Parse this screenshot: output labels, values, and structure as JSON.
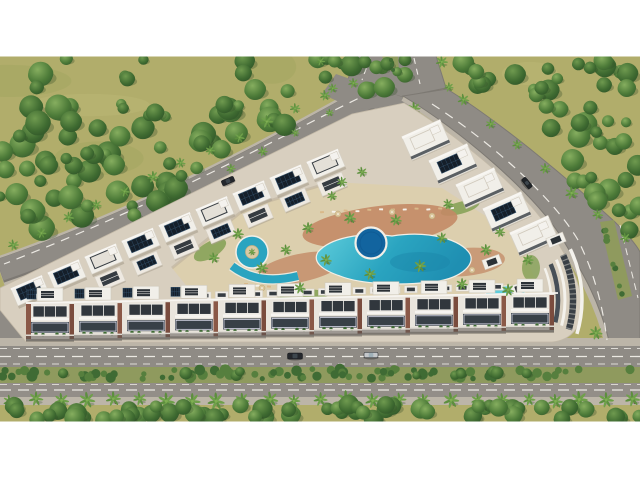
{
  "scene": {
    "title": "Aerial 3D architectural render of a residential resort complex",
    "style": "top-down oblique 3D visualization, letterboxed with white bars",
    "setting": "Perimeter apartment blocks with rooftop solar panels enclosing a landscaped courtyard with lagoon-style pools; dense woodland to the north and east; palm-lined boulevard along the south",
    "pool_count": 5,
    "building_wings": 4,
    "cars_visible": 4
  },
  "colors": {
    "letterbox": "#ffffff",
    "grass": "#b1ad6b",
    "grassLight": "#c3bf7e",
    "grassDark": "#97a158",
    "shadow": "#2e4a26",
    "shrub": "#3f6b34",
    "shrubAlt": "#567f3e",
    "palmFrond": "#5d8f3e",
    "palmFrondAlt": "#6fa04a",
    "palmTrunk": "#6b5236",
    "road": "#8f8b85",
    "roadAlt": "#938e88",
    "roadEdge": "#7d7973",
    "laneDash": "#ece9e3",
    "sidewalk": "#bcb5a8",
    "medianGrass": "#8f9a5e",
    "deck": "#d8cfbf",
    "deckEdge": "#c3b9a7",
    "sand": "#dccfae",
    "terracotta": "#c38a66",
    "poolLight": "#5ecddb",
    "poolMid": "#2aa4c0",
    "poolDeep": "#12649f",
    "poolCoping": "#f2efe7",
    "bldgWhite": "#f1efe9",
    "bldgTrim": "#d6d0c4",
    "bldgDark": "#363c42",
    "brick": "#8a5847",
    "solar": "#151f2a",
    "solarGrid": "#33516c",
    "carDark": "#24272c",
    "carSilver": "#c4c7ca"
  },
  "roads": {
    "north_entry": "divided entry road",
    "west_road": "tree-lined avenue (northwest)",
    "east_road": "palm-lined avenue (east)",
    "south_boulevard": "palm-lined boulevard with planted median"
  },
  "regions": {
    "forest": [
      {
        "name": "northwest-forest",
        "polygon": [
          [
            0,
            58
          ],
          [
            348,
            58
          ],
          [
            388,
            86
          ],
          [
            322,
            108
          ],
          [
            140,
            216
          ],
          [
            0,
            252
          ]
        ],
        "count": 90,
        "rmin": 5,
        "rmax": 13
      },
      {
        "name": "east-forest",
        "polygon": [
          [
            452,
            58
          ],
          [
            640,
            58
          ],
          [
            640,
            244
          ],
          [
            612,
            216
          ],
          [
            500,
            116
          ]
        ],
        "count": 52,
        "rmin": 5,
        "rmax": 12
      },
      {
        "name": "junction-wedge",
        "polygon": [
          [
            352,
            58
          ],
          [
            446,
            58
          ],
          [
            440,
            80
          ],
          [
            390,
            78
          ]
        ],
        "count": 7,
        "rmin": 4,
        "rmax": 8
      },
      {
        "name": "south-green-belt",
        "polygon": [
          [
            0,
            404
          ],
          [
            640,
            404
          ],
          [
            640,
            420
          ],
          [
            0,
            420
          ]
        ],
        "count": 60,
        "rmin": 6,
        "rmax": 10
      }
    ],
    "shrub_bands": [
      {
        "name": "boulevard-median",
        "from": [
          4,
          374
        ],
        "to": [
          636,
          374
        ],
        "count": 90,
        "rmin": 2.5,
        "rmax": 5.5,
        "jitter": 5
      },
      {
        "name": "boulevard-median-trees",
        "from": [
          20,
          373
        ],
        "to": [
          620,
          373
        ],
        "count": 10,
        "rmin": 4,
        "rmax": 6.5,
        "jitter": 3,
        "tree": true
      },
      {
        "name": "east-road-median",
        "from": [
          604,
          226
        ],
        "to": [
          624,
          294
        ],
        "count": 9,
        "rmin": 2,
        "rmax": 3.5,
        "jitter": 2
      },
      {
        "name": "courtyard-edge",
        "from": [
          200,
          294
        ],
        "to": [
          496,
          286
        ],
        "count": 26,
        "rmin": 1.5,
        "rmax": 3,
        "jitter": 2
      }
    ],
    "palm_lines": [
      {
        "name": "west-road-upper",
        "from": [
          352,
          82
        ],
        "to": [
          12,
          246
        ],
        "count": 13,
        "scale": 0.85
      },
      {
        "name": "west-road-mid",
        "from": [
          330,
          112
        ],
        "to": [
          230,
          170
        ],
        "count": 4,
        "scale": 0.7
      },
      {
        "name": "entry-west",
        "from": [
          320,
          62
        ],
        "to": [
          334,
          88
        ],
        "count": 2,
        "scale": 0.8
      },
      {
        "name": "entry-east",
        "from": [
          442,
          62
        ],
        "to": [
          450,
          86
        ],
        "count": 2,
        "scale": 0.8
      },
      {
        "name": "east-road-west-side",
        "from": [
          414,
          108
        ],
        "to": [
          596,
          332
        ],
        "count": 10,
        "scale": 0.95
      },
      {
        "name": "east-road-east-side",
        "from": [
          462,
          100
        ],
        "to": [
          626,
          238
        ],
        "count": 7,
        "scale": 0.9
      },
      {
        "name": "boulevard-row",
        "from": [
          10,
          400
        ],
        "to": [
          632,
          400
        ],
        "count": 25,
        "scale": 1.1
      }
    ],
    "courtyard_palms": [
      [
        238,
        234,
        0.9
      ],
      [
        262,
        268,
        0.95
      ],
      [
        286,
        250,
        0.85
      ],
      [
        308,
        228,
        0.9
      ],
      [
        326,
        260,
        0.9
      ],
      [
        350,
        218,
        0.95
      ],
      [
        370,
        274,
        0.9
      ],
      [
        396,
        220,
        0.9
      ],
      [
        420,
        266,
        0.95
      ],
      [
        442,
        238,
        0.85
      ],
      [
        462,
        284,
        0.9
      ],
      [
        486,
        250,
        0.9
      ],
      [
        508,
        290,
        0.95
      ],
      [
        528,
        260,
        0.85
      ],
      [
        300,
        288,
        0.9
      ],
      [
        214,
        258,
        0.85
      ],
      [
        342,
        182,
        0.8
      ],
      [
        362,
        172,
        0.8
      ],
      [
        252,
        252,
        0.55
      ],
      [
        332,
        196,
        0.75
      ],
      [
        448,
        204,
        0.8
      ],
      [
        500,
        232,
        0.8
      ]
    ]
  },
  "pool_furniture": {
    "lounger_rows": [
      {
        "from": [
          322,
          212
        ],
        "to": [
          452,
          208
        ],
        "count": 12
      },
      {
        "from": [
          246,
          284
        ],
        "to": [
          292,
          290
        ],
        "count": 5
      }
    ],
    "umbrellas": [
      [
        338,
        214
      ],
      [
        392,
        212
      ],
      [
        432,
        216
      ],
      [
        262,
        288
      ],
      [
        472,
        270
      ]
    ]
  },
  "cars": [
    {
      "name": "sedan-on-west-road",
      "x": 228,
      "y": 181,
      "angle": -23,
      "length": 13,
      "width": 5.5,
      "color": "#24272c"
    },
    {
      "name": "sedan-on-east-road",
      "x": 527,
      "y": 183,
      "angle": 51,
      "length": 12,
      "width": 5,
      "color": "#1f2327"
    },
    {
      "name": "sedan-on-boulevard",
      "x": 295,
      "y": 356,
      "angle": 0,
      "length": 15,
      "width": 6,
      "color": "#24272c"
    },
    {
      "name": "silver-car-on-boulevard",
      "x": 371,
      "y": 355,
      "angle": 0,
      "length": 14,
      "width": 5.5,
      "color": "#c4c7ca"
    }
  ]
}
